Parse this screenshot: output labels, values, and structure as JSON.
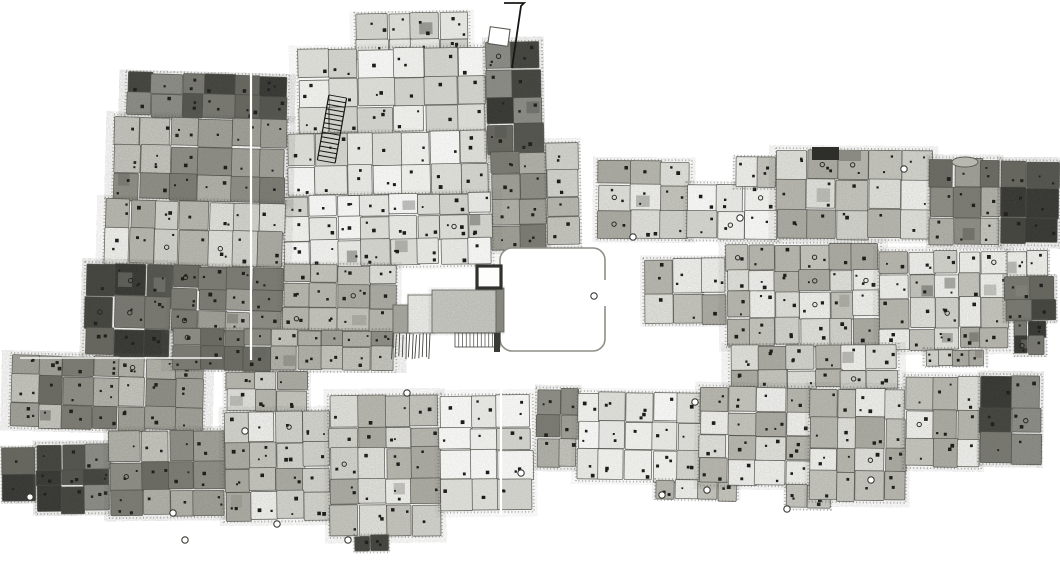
{
  "meta": {
    "scene": "hand-drawn stippled plan of a dense settlement of packed rectangular rooms around a central walled courtyard",
    "canvas": {
      "width": 1060,
      "height": 578
    },
    "background": "#ffffff"
  },
  "palette": {
    "ink": "#171714",
    "line": "#4a4a44",
    "fringe": "#5a5a52",
    "seam": "#ffffff",
    "shades": {
      "light": [
        "#fafaf8",
        "#f3f3f0",
        "#ebebe7",
        "#e1e1dc",
        "#d6d6d0"
      ],
      "medium": [
        "#f2f2ef",
        "#e3e3de",
        "#d5d5cf",
        "#c7c7c0",
        "#b9b9b1",
        "#adada5"
      ],
      "dark": [
        "#c9c9c2",
        "#b5b5ad",
        "#a3a39b",
        "#909088",
        "#7d7d75",
        "#6b6b64"
      ],
      "vdark": [
        "#90908a",
        "#7b7b74",
        "#676760",
        "#53534d",
        "#41413c",
        "#33332f"
      ]
    },
    "grain_opacity": {
      "light": 0.13,
      "medium": 0.2,
      "dark": 0.27,
      "vdark": 0.33
    }
  },
  "clusters": [
    {
      "name": "north-block",
      "rotate": -1.0,
      "parts": [
        {
          "x": 358,
          "y": 13,
          "w": 112,
          "h": 47,
          "shade": "light",
          "cell": 30
        },
        {
          "x": 300,
          "y": 48,
          "w": 187,
          "h": 84,
          "shade": "light",
          "cell": 29
        },
        {
          "x": 288,
          "y": 132,
          "w": 199,
          "h": 62,
          "shade": "light",
          "cell": 28
        },
        {
          "x": 487,
          "y": 44,
          "w": 55,
          "h": 110,
          "shade": "vdark",
          "cell": 26
        },
        {
          "x": 490,
          "y": 154,
          "w": 56,
          "h": 96,
          "shade": "dark",
          "cell": 26
        },
        {
          "x": 283,
          "y": 194,
          "w": 207,
          "h": 71,
          "shade": "light",
          "cell": 27
        },
        {
          "x": 546,
          "y": 146,
          "w": 32,
          "h": 102,
          "shade": "medium",
          "cell": 27
        }
      ]
    },
    {
      "name": "west-arm",
      "rotate": 1.5,
      "parts": [
        {
          "x": 123,
          "y": 73,
          "w": 160,
          "h": 44,
          "shade": "vdark",
          "cell": 27
        },
        {
          "x": 112,
          "y": 117,
          "w": 171,
          "h": 83,
          "shade": "dark",
          "cell": 27
        },
        {
          "x": 105,
          "y": 200,
          "w": 178,
          "h": 65,
          "shade": "medium",
          "cell": 27
        },
        {
          "x": 87,
          "y": 265,
          "w": 86,
          "h": 92,
          "shade": "vdark",
          "cell": 27
        },
        {
          "x": 173,
          "y": 265,
          "w": 110,
          "h": 65,
          "shade": "dark",
          "cell": 26
        },
        {
          "x": 15,
          "y": 358,
          "w": 192,
          "h": 72,
          "shade": "dark",
          "cell": 27
        }
      ]
    },
    {
      "name": "central-belt",
      "rotate": 0.4,
      "parts": [
        {
          "x": 283,
          "y": 265,
          "w": 112,
          "h": 65,
          "shade": "medium",
          "cell": 26
        },
        {
          "x": 173,
          "y": 330,
          "w": 222,
          "h": 40,
          "shade": "dark",
          "cell": 26
        },
        {
          "x": 227,
          "y": 372,
          "w": 80,
          "h": 40,
          "shade": "medium",
          "cell": 24
        }
      ]
    },
    {
      "name": "southwest-band",
      "rotate": -0.6,
      "parts": [
        {
          "x": 3,
          "y": 446,
          "w": 34,
          "h": 52,
          "shade": "vdark",
          "cell": 24
        },
        {
          "x": 37,
          "y": 442,
          "w": 73,
          "h": 68,
          "shade": "vdark",
          "cell": 26
        },
        {
          "x": 110,
          "y": 430,
          "w": 115,
          "h": 85,
          "shade": "dark",
          "cell": 27
        },
        {
          "x": 225,
          "y": 412,
          "w": 105,
          "h": 108,
          "shade": "medium",
          "cell": 27
        },
        {
          "x": 330,
          "y": 397,
          "w": 110,
          "h": 140,
          "shade": "medium",
          "cell": 27
        },
        {
          "x": 440,
          "y": 398,
          "w": 92,
          "h": 115,
          "shade": "light",
          "cell": 27
        },
        {
          "x": 355,
          "y": 537,
          "w": 32,
          "h": 15,
          "shade": "vdark",
          "cell": 15
        }
      ]
    },
    {
      "name": "northeast-band",
      "rotate": 0.5,
      "parts": [
        {
          "x": 598,
          "y": 163,
          "w": 92,
          "h": 77,
          "shade": "medium",
          "cell": 27
        },
        {
          "x": 688,
          "y": 185,
          "w": 89,
          "h": 55,
          "shade": "light",
          "cell": 26
        },
        {
          "x": 735,
          "y": 158,
          "w": 42,
          "h": 30,
          "shade": "medium",
          "cell": 21
        },
        {
          "x": 777,
          "y": 150,
          "w": 153,
          "h": 88,
          "shade": "medium",
          "cell": 28
        },
        {
          "x": 930,
          "y": 158,
          "w": 70,
          "h": 85,
          "shade": "dark",
          "cell": 27
        },
        {
          "x": 1000,
          "y": 160,
          "w": 58,
          "h": 82,
          "shade": "vdark",
          "cell": 27
        }
      ]
    },
    {
      "name": "east-belt",
      "rotate": -0.4,
      "parts": [
        {
          "x": 645,
          "y": 258,
          "w": 82,
          "h": 64,
          "shade": "medium",
          "cell": 26
        },
        {
          "x": 727,
          "y": 244,
          "w": 153,
          "h": 101,
          "shade": "medium",
          "cell": 27
        },
        {
          "x": 880,
          "y": 252,
          "w": 128,
          "h": 98,
          "shade": "medium",
          "cell": 27
        },
        {
          "x": 925,
          "y": 350,
          "w": 60,
          "h": 16,
          "shade": "medium",
          "cell": 16
        },
        {
          "x": 1008,
          "y": 252,
          "w": 40,
          "h": 26,
          "shade": "medium",
          "cell": 20
        },
        {
          "x": 1005,
          "y": 278,
          "w": 50,
          "h": 44,
          "shade": "vdark",
          "cell": 24
        },
        {
          "x": 1015,
          "y": 322,
          "w": 30,
          "h": 34,
          "shade": "vdark",
          "cell": 17
        },
        {
          "x": 730,
          "y": 345,
          "w": 167,
          "h": 43,
          "shade": "medium",
          "cell": 26
        }
      ]
    },
    {
      "name": "southeast-band",
      "rotate": 0.7,
      "parts": [
        {
          "x": 537,
          "y": 392,
          "w": 41,
          "h": 78,
          "shade": "dark",
          "cell": 24
        },
        {
          "x": 578,
          "y": 395,
          "w": 122,
          "h": 87,
          "shade": "light",
          "cell": 27
        },
        {
          "x": 657,
          "y": 482,
          "w": 80,
          "h": 18,
          "shade": "medium",
          "cell": 18
        },
        {
          "x": 700,
          "y": 388,
          "w": 110,
          "h": 97,
          "shade": "medium",
          "cell": 27
        },
        {
          "x": 787,
          "y": 485,
          "w": 43,
          "h": 23,
          "shade": "medium",
          "cell": 20
        },
        {
          "x": 810,
          "y": 388,
          "w": 95,
          "h": 112,
          "shade": "medium",
          "cell": 27
        },
        {
          "x": 905,
          "y": 375,
          "w": 75,
          "h": 90,
          "shade": "medium",
          "cell": 27
        },
        {
          "x": 980,
          "y": 373,
          "w": 60,
          "h": 87,
          "shade": "vdark",
          "cell": 27
        }
      ]
    }
  ],
  "features": {
    "plaza": {
      "x": 500,
      "y": 248,
      "w": 105,
      "h": 103,
      "rx": 12,
      "stroke": "#8f8f88",
      "stroke_width": 1.6,
      "fill": "#ffffff"
    },
    "plaza_gap": {
      "x": 598,
      "y": 280,
      "w": 10,
      "h": 26
    },
    "tower": {
      "x": 477,
      "y": 266,
      "w": 24,
      "h": 22,
      "stroke": "#30302c",
      "stroke_width": 3.2,
      "fill": "#fdfdfc"
    },
    "annex_blocks": [
      {
        "x": 393,
        "y": 305,
        "w": 19,
        "h": 28,
        "fill": "#a8a8a1"
      },
      {
        "x": 408,
        "y": 295,
        "w": 26,
        "h": 38,
        "fill": "#eeeeea"
      },
      {
        "x": 432,
        "y": 290,
        "w": 64,
        "h": 43,
        "fill": "#c9c9c3"
      },
      {
        "x": 496,
        "y": 288,
        "w": 8,
        "h": 44,
        "fill": "#8a8a83"
      }
    ],
    "fence_vertical": {
      "x": 393,
      "y": 333,
      "w": 37,
      "h": 27,
      "lines": 12
    },
    "comb": {
      "x": 455,
      "y": 333,
      "w": 45,
      "h": 14,
      "lines": 12
    },
    "post": {
      "x": 494,
      "y": 333,
      "w": 6,
      "h": 19,
      "fill": "#3a3a35"
    },
    "ladder": {
      "x": 323,
      "y": 96,
      "w": 18,
      "h": 66,
      "rungs": 14,
      "rotate": 10
    },
    "flag": {
      "polyline": "504,3 524,3 521,6 512,68",
      "square": {
        "x": 489,
        "y": 28,
        "w": 20,
        "h": 17,
        "rotate": 8
      }
    },
    "caps": [
      {
        "x": 812,
        "y": 147,
        "w": 27,
        "h": 13,
        "fill": "#2e2e2a"
      },
      {
        "x": 839,
        "y": 151,
        "w": 22,
        "h": 10,
        "fill": "#8a8a82"
      }
    ],
    "mound": {
      "cx": 965,
      "cy": 162,
      "rx": 13,
      "ry": 5,
      "fill": "#b8b8b1"
    },
    "circles": [
      [
        904,
        169
      ],
      [
        740,
        218
      ],
      [
        633,
        237
      ],
      [
        594,
        296
      ],
      [
        407,
        393
      ],
      [
        245,
        431
      ],
      [
        173,
        513
      ],
      [
        185,
        540
      ],
      [
        277,
        524
      ],
      [
        348,
        540
      ],
      [
        521,
        473
      ],
      [
        695,
        402
      ],
      [
        662,
        495
      ],
      [
        707,
        490
      ],
      [
        787,
        509
      ],
      [
        871,
        480
      ],
      [
        30,
        497
      ]
    ],
    "seams": {
      "vertical": [
        {
          "x": 251,
          "y1": 70,
          "y2": 360
        },
        {
          "x": 501,
          "y1": 260,
          "y2": 515
        }
      ],
      "horizontal": [
        {
          "y": 358,
          "x1": 20,
          "x2": 222
        }
      ]
    }
  }
}
